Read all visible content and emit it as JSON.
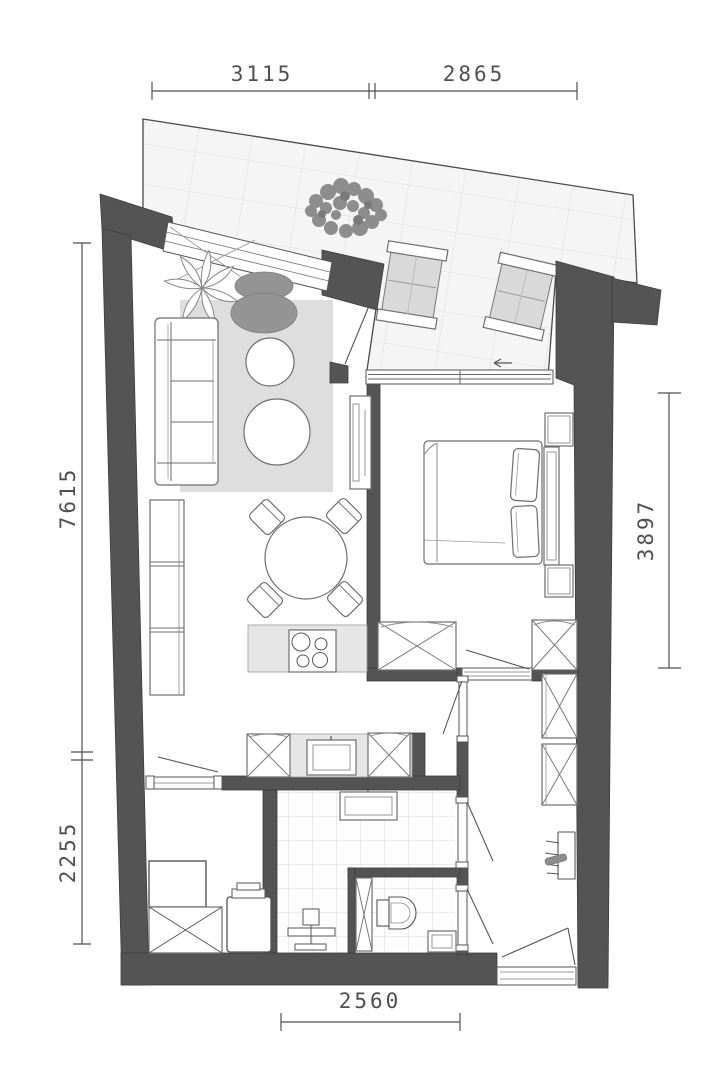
{
  "plan": {
    "dimensions": {
      "top_left": "3115",
      "top_right": "2865",
      "side_left_upper": "7615",
      "side_left_lower": "2255",
      "side_right": "3897",
      "bottom": "2560"
    },
    "colors": {
      "wall": "#545454",
      "balcony_tile": "#f5f5f5",
      "tile_grid_line": "#dcdcdc",
      "rug": "#dedede",
      "armchair": "#949494",
      "shrub": "#8d8d8d",
      "counter": "#e6e6e6",
      "lounger_cushion": "#d9d9d9",
      "dimension_ink": "#4f4f4f",
      "background": "#ffffff"
    }
  }
}
